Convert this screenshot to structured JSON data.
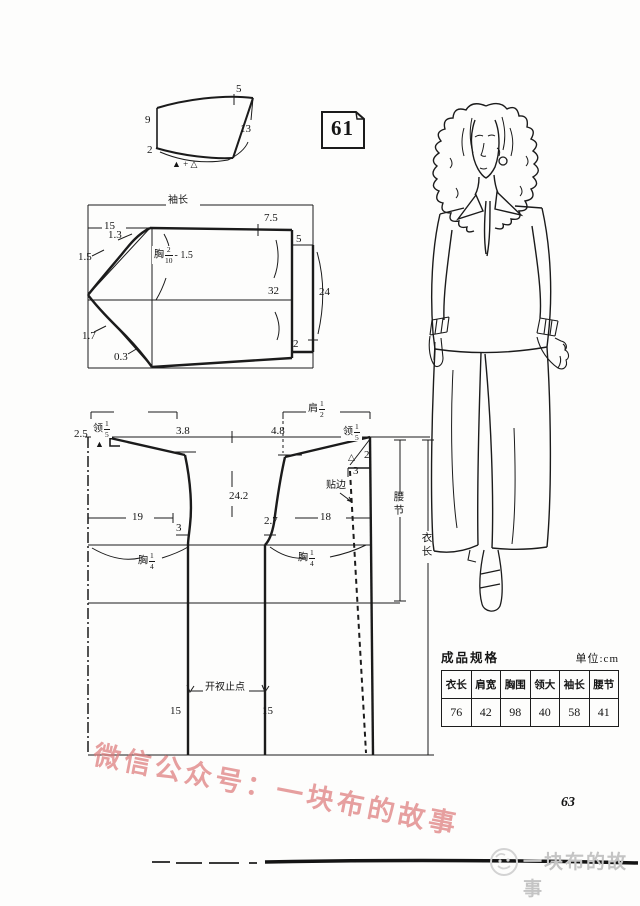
{
  "page_number": "63",
  "pattern_number": "61",
  "colors": {
    "ink": "#1a1a1a",
    "watermark": "#de7c7c",
    "footer_gray": "#c4c4c4"
  },
  "collar": {
    "top": "5",
    "left": "9",
    "right": "13",
    "bottom_left": "2",
    "fold_note": "▲ + △"
  },
  "sleeve": {
    "title": "袖长",
    "cap_width": "15",
    "cap_offset_upper": "1.3",
    "cap_offset_mid": "1.5",
    "cap_height": {
      "pre": "胸",
      "num": "2",
      "den": "10",
      "post": "- 1.5"
    },
    "cuff_top": "7.5",
    "placket_width": "5",
    "elbow": "32",
    "cuff_depth": "24",
    "hem_offset_upper": "1.7",
    "hem_offset_lower": "0.3",
    "cuff_bottom": "2"
  },
  "bodice": {
    "back_neck_rise": "2.5",
    "neck_fifth": {
      "pre": "领",
      "num": "1",
      "den": "5"
    },
    "shoulder_half": {
      "pre": "肩",
      "num": "1",
      "den": "2"
    },
    "back_shoulder_slope": "3.8",
    "front_shoulder_slope": "4.8",
    "marker_solid": "▲",
    "marker_open": "△",
    "front_neck_drop": "2",
    "front_neck_width": "3",
    "cross_width": "24.2",
    "back_width": "19",
    "front_width": "18",
    "back_gap": "3",
    "front_gap": "2.7",
    "facing": "贴边",
    "chest_quarter": {
      "pre": "胸",
      "num": "1",
      "den": "4"
    },
    "waist_label": "腰节",
    "length_label": "衣长",
    "slit_label": "开衩止点",
    "slit_left": "15",
    "slit_right": "15"
  },
  "spec_table": {
    "title": "成品规格",
    "unit": "单位:cm",
    "headers": [
      "衣长",
      "肩宽",
      "胸围",
      "领大",
      "袖长",
      "腰节"
    ],
    "values": [
      "76",
      "42",
      "98",
      "40",
      "58",
      "41"
    ]
  },
  "watermark": {
    "text": "微信公众号：一块布的故事"
  },
  "footer": {
    "brand": "一块布的故事"
  }
}
